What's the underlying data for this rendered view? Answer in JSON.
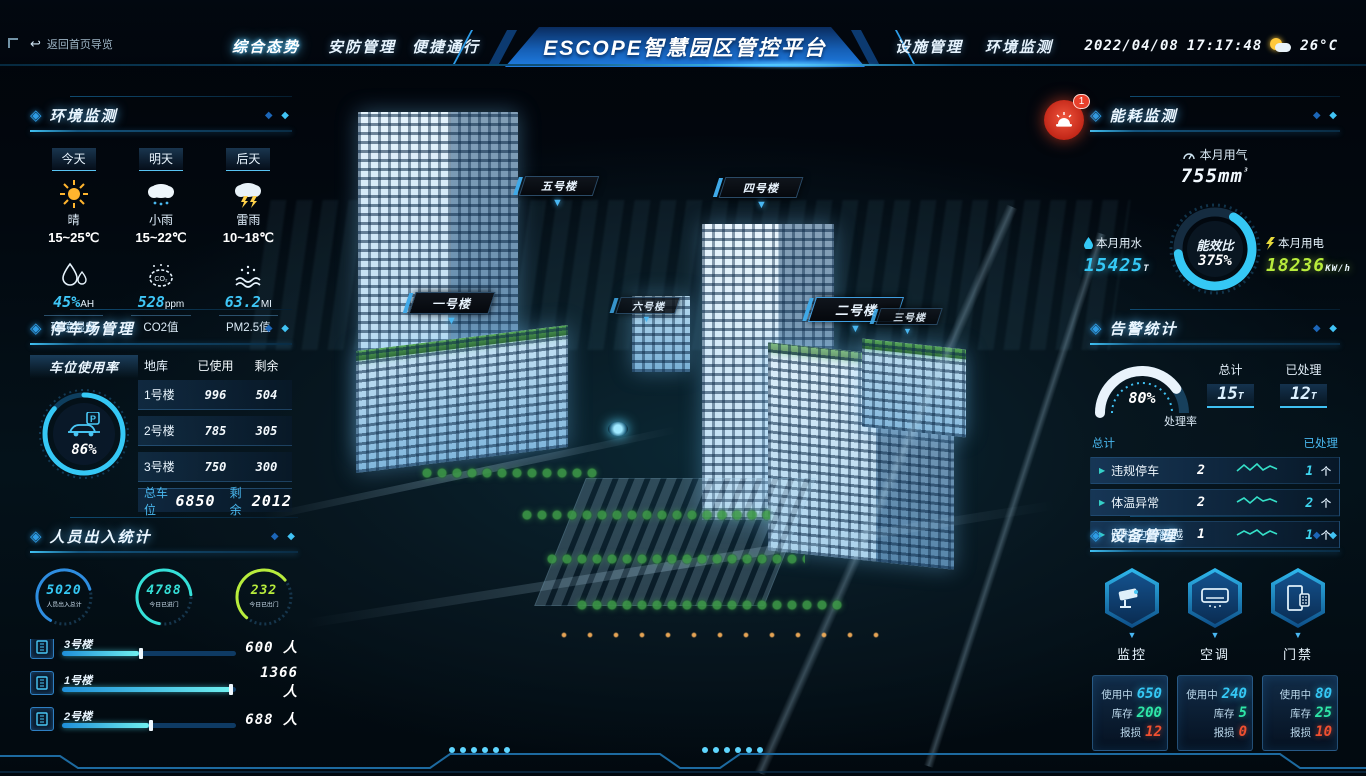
{
  "header": {
    "back_label": "返回首页导览",
    "tabs": [
      {
        "label": "综合态势",
        "active": true
      },
      {
        "label": "安防管理",
        "active": false
      },
      {
        "label": "便捷通行",
        "active": false
      },
      {
        "label": "设施管理",
        "active": false
      },
      {
        "label": "环境监测",
        "active": false
      }
    ],
    "title": "ESCOPE智慧园区管控平台",
    "date": "2022/04/08",
    "time": "17:17:48",
    "temperature": "26°C"
  },
  "colors": {
    "accent_cyan": "#35c8f5",
    "accent_green": "#b8ec3c",
    "accent_teal": "#2ee6a8",
    "alert_red": "#e8402c",
    "title_blue": "#1f7ce2"
  },
  "env": {
    "title": "环境监测",
    "forecast": [
      {
        "day": "今天",
        "icon": "sun-icon",
        "cond": "晴",
        "temp": "15~25℃"
      },
      {
        "day": "明天",
        "icon": "rain-cloud-icon",
        "cond": "小雨",
        "temp": "15~22℃"
      },
      {
        "day": "后天",
        "icon": "storm-cloud-icon",
        "cond": "雷雨",
        "temp": "10~18℃"
      }
    ],
    "metrics": [
      {
        "icon": "humidity-icon",
        "value": "45%",
        "unit": "AH",
        "label": "环境湿度"
      },
      {
        "icon": "co2-icon",
        "value": "528",
        "unit": "ppm",
        "label": "CO2值"
      },
      {
        "icon": "pm25-icon",
        "value": "63.2",
        "unit": "MI",
        "label": "PM2.5值"
      }
    ]
  },
  "parking": {
    "title": "停车场管理",
    "gauge_label": "车位使用率",
    "usage_pct": "86%",
    "headers": [
      "地库",
      "已使用",
      "剩余"
    ],
    "rows": [
      {
        "name": "1号楼",
        "used": "996",
        "left": "504"
      },
      {
        "name": "2号楼",
        "used": "785",
        "left": "305"
      },
      {
        "name": "3号楼",
        "used": "750",
        "left": "300"
      }
    ],
    "total_label": "总车位",
    "total": "6850",
    "remain_label": "剩余",
    "remain": "2012"
  },
  "people": {
    "title": "人员出入统计",
    "stats": [
      {
        "value": "5020",
        "label": "人员出入总计",
        "color": "#35c8f5"
      },
      {
        "value": "4788",
        "label": "今日已进门",
        "color": "#35e0d8"
      },
      {
        "value": "232",
        "label": "今日已出门",
        "color": "#b8ec3c"
      }
    ],
    "sliders": [
      {
        "label": "3号楼",
        "value": "600 人",
        "pct": 44
      },
      {
        "label": "1号楼",
        "value": "1366 人",
        "pct": 97
      },
      {
        "label": "2号楼",
        "value": "688 人",
        "pct": 50
      }
    ]
  },
  "energy": {
    "title": "能耗监测",
    "gas_label": "本月用气",
    "gas_value": "755mm",
    "gas_sup": "³",
    "ratio_label": "能效比",
    "ratio_value": "375%",
    "water_label": "本月用水",
    "water_value": "15425",
    "water_unit": "T",
    "elec_label": "本月用电",
    "elec_value": "18236",
    "elec_unit": "KW/h"
  },
  "alarm": {
    "title": "告警统计",
    "badge": "1",
    "rate_pct": "80%",
    "rate_label": "处理率",
    "total_label": "总计",
    "total_value": "15",
    "total_unit": "T",
    "handled_label": "已处理",
    "handled_value": "12",
    "handled_unit": "T",
    "col_total": "总计",
    "col_handled": "已处理",
    "rows": [
      {
        "name": "违规停车",
        "total": "2",
        "handled": "1",
        "unit": "个"
      },
      {
        "name": "体温异常",
        "total": "2",
        "handled": "2",
        "unit": "个"
      },
      {
        "name": "围栏边界翻越",
        "total": "1",
        "handled": "1",
        "unit": "个"
      }
    ]
  },
  "devices": {
    "title": "设备管理",
    "in_use_label": "使用中",
    "stock_label": "库存",
    "broken_label": "报损",
    "items": [
      {
        "name": "监控",
        "icon": "cctv-icon",
        "in_use": "650",
        "stock": "200",
        "broken": "12"
      },
      {
        "name": "空调",
        "icon": "ac-icon",
        "in_use": "240",
        "stock": "5",
        "broken": "0"
      },
      {
        "name": "门禁",
        "icon": "door-access-icon",
        "in_use": "80",
        "stock": "25",
        "broken": "10"
      }
    ]
  },
  "scene": {
    "labels": [
      "五号楼",
      "四号楼",
      "一号楼",
      "六号楼",
      "二号楼",
      "三号楼"
    ]
  }
}
